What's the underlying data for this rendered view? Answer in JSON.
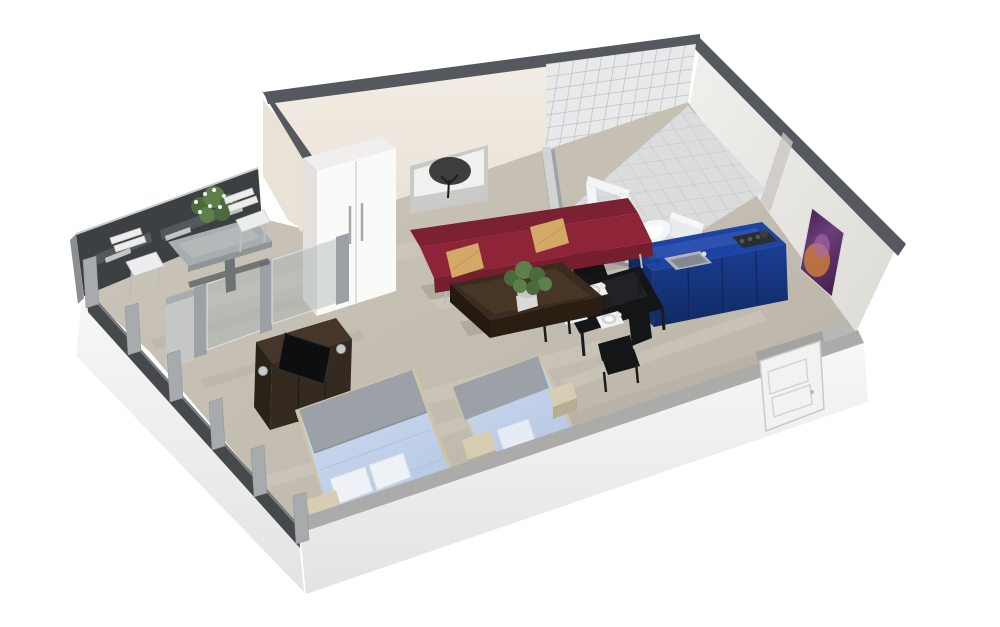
{
  "scene": {
    "type": "isometric-3d-floor-plan",
    "subject": "studio-apartment-cutaway-render",
    "objects": [
      "glass-facade",
      "outdoor-dining-table",
      "outdoor-chairs",
      "table-planter",
      "glass-partition",
      "wardrobe",
      "tree-wall-art",
      "sofa",
      "throw-pillows",
      "coffee-table",
      "potted-plant",
      "bathroom-tiled-wall",
      "bathroom-tiled-floor",
      "shower-frame",
      "toilet",
      "kitchen-counter",
      "kitchen-sink",
      "cooktop",
      "dining-table",
      "place-settings",
      "dining-chairs",
      "double-bed",
      "single-bed",
      "bed-pillows",
      "nightstands",
      "tv-dresser",
      "television",
      "table-lamps",
      "entrance-door",
      "purple-wall-art",
      "window-posts",
      "floor-slab"
    ]
  },
  "colors": {
    "background": "#ffffff",
    "wall_top": "#55595d",
    "wall_cream": "#f0eae1",
    "wall_west_outer": "#e9e2d7",
    "floor_light": "#d8d3c9",
    "floor_dark": "#a9a195",
    "slab_strip": "#ababa9",
    "window_glass_dark": "#3c4043",
    "window_post": "#a7abae",
    "partition_glass": "#a9b3b4",
    "partition_post": "#9ba1a4",
    "tile": "#e8e9ea",
    "grout": "#b3b6b8",
    "tile_floor": "#dcdedf",
    "toilet": "#f3f5f6",
    "kitchen_top": "#1d44a4",
    "kitchen_side": "#122f6d",
    "sink": "#aeb4ba",
    "cooktop": "#2b2e31",
    "dining_black": "#141517",
    "mat": "#f1f1f1",
    "plate": "#dcdcdc",
    "sofa": "#8e2438",
    "sofa_back": "#7c2033",
    "sofa_front": "#741e2e",
    "pillow": "#d2a967",
    "coffee_table": "#3a2b1e",
    "coffee_table_dark": "#2a1e13",
    "wardrobe": "#fafaf9",
    "wardrobe_side": "#e3e1de",
    "handle": "#a8a8a8",
    "dresser": "#352a20",
    "dresser_top": "#453629",
    "tv": "#0d0e10",
    "bed_gray": "#9ba1a7",
    "bed_frame": "#cfc3a6",
    "pillow_white": "#eef2f7",
    "nightstand": "#d6cdb2",
    "nightstand_front": "#b8ad90",
    "door": "#f2f2f1",
    "door_frame": "#c9c9c7",
    "stone_table": "#a8adb0",
    "chair_white": "#eceeee",
    "plant_green": "#4c6b3c",
    "plant_green_light": "#5e7f49"
  }
}
